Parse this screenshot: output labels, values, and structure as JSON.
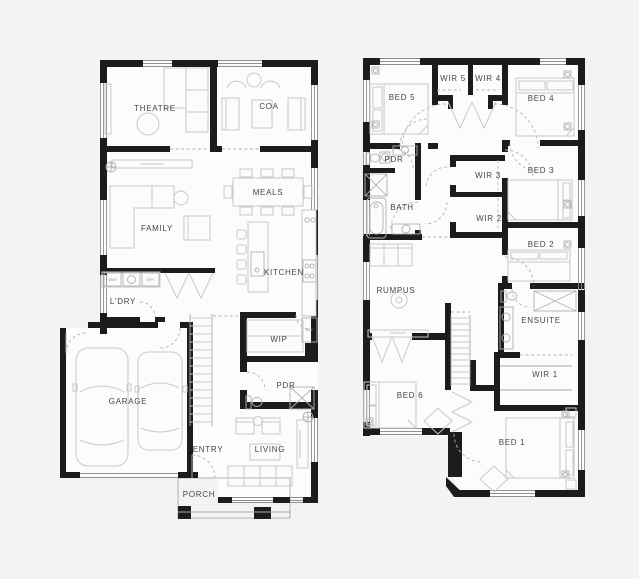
{
  "colors": {
    "background": "#f3f3f1",
    "wall": "#1c1c1c",
    "floor": "#fcfcfb",
    "furniture_stroke": "#c9c9c9",
    "fixture_stroke": "#b2b2b2",
    "label_text": "#464646"
  },
  "ground": {
    "theatre": "THEATRE",
    "coa": "COA",
    "family": "FAMILY",
    "meals": "MEALS",
    "kitchen": "KITCHEN",
    "laundry": "L'DRY",
    "wip": "WIP",
    "garage": "GARAGE",
    "powder": "PDR",
    "entry": "ENTRY",
    "living": "LIVING",
    "porch": "PORCH",
    "washer": "W/M",
    "dryer": "DRY",
    "fridge": "REF"
  },
  "first": {
    "bed5": "BED 5",
    "wir5": "WIR 5",
    "wir4": "WIR 4",
    "bed4": "BED 4",
    "powder": "PDR",
    "wir3": "WIR 3",
    "bed3": "BED 3",
    "bath": "BATH",
    "wir2": "WIR 2",
    "bed2": "BED 2",
    "rumpus": "RUMPUS",
    "ensuite": "ENSUITE",
    "wir1": "WIR 1",
    "bed6": "BED 6",
    "bed1": "BED 1"
  }
}
